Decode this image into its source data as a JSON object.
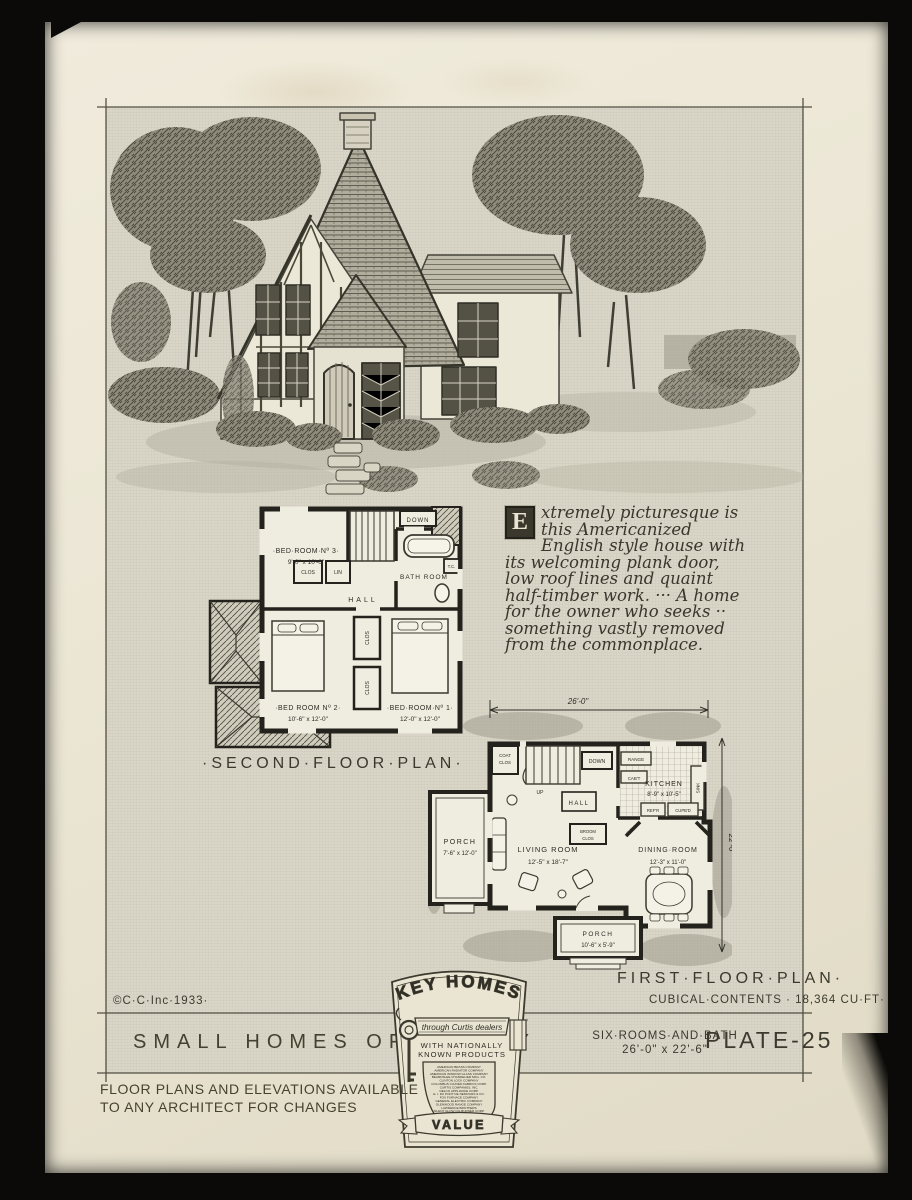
{
  "description": {
    "initial": "E",
    "lines": [
      "xtremely picturesque is",
      "this Americanized",
      "English style house with",
      "its welcoming plank door,",
      "low roof lines and quaint",
      "half-timber work. ··· A home",
      "for the owner who seeks ··",
      "something vastly removed",
      "from the commonplace."
    ]
  },
  "second_floor": {
    "title": "·SECOND·FLOOR·PLAN·",
    "bedroom3_name": "·BED·ROOM·Nº 3·",
    "bedroom3_dims": "9'-0\" x 10'-0\"",
    "bedroom2_name": "·BED ROOM Nº 2·",
    "bedroom2_dims": "10'-6\" x 12'-0\"",
    "bedroom1_name": "·BED·ROOM·Nº 1·",
    "bedroom1_dims": "12'-0\" x 12'-0\"",
    "bathroom": "BATH ROOM",
    "hall": "HALL",
    "closet_a": "CLOS",
    "linen": "LIN",
    "down": "DOWN",
    "tc": "T.C.",
    "closet_b": "CLOS",
    "closet_c": "CLOS"
  },
  "first_floor": {
    "title": "FIRST·FLOOR·PLAN·",
    "living_name": "LIVING ROOM",
    "living_dims": "12'-5\" x 18'-7\"",
    "dining_name": "DINING·ROOM",
    "dining_dims": "12'-3\" x 11'-0\"",
    "kitchen_name": "KITCHEN",
    "kitchen_dims": "8'-9\" x 10'-5\"",
    "porch_side_name": "PORCH",
    "porch_side_dims": "7'-6\" x 12'-0\"",
    "porch_front_name": "PORCH",
    "porch_front_dims": "10'-6\" x 5'-9\"",
    "hall": "HALL",
    "coat1": "COAT",
    "coat2": "CLOS",
    "up": "UP",
    "down": "DOWN",
    "range": "RANGE",
    "cabt": "CAB'T",
    "sink": "SINK",
    "refr": "REF'R",
    "cupbd": "CUPB'D",
    "broom1": "BROOM",
    "broom2": "CLOS",
    "china_left": "CHINA",
    "china_right": "CHINA",
    "dim_width": "26'-0\"",
    "dim_depth": "22'-6\""
  },
  "titleblock": {
    "copyright": "©C·C·Inc·1933·",
    "cubical": "CUBICAL·CONTENTS · 18,364 CU·FT·",
    "series": "SMALL HOMES OF TO·DAY",
    "rooms_line1": "SIX·ROOMS·AND·BATH",
    "rooms_line2": "26'-0\" x 22'-6\"",
    "plate": "PLATE-25"
  },
  "emblem": {
    "title": "KEY HOMES",
    "banner": "through Curtis dealers",
    "tagline1": "WITH NATIONALLY",
    "tagline2": "KNOWN PRODUCTS",
    "companies": [
      "AMERICAN BRASS COMPANY",
      "AMERICAN RADIATOR COMPANY",
      "AMERICAN WINDOW GLASS COMPANY",
      "BEARDSLEE CHANDELIER MFG. CO.",
      "CLINTON LOCK COMPANY",
      "COLUMBUS COATED FABRICS CORP.",
      "CURTIS COMPANIES, INC.",
      "DELCO APPLIANCE CORP.",
      "E. I. DU PONT DE NEMOURS & CO.",
      "FOX FURNACE COMPANY",
      "GENERAL ELECTRIC COMPANY",
      "GLENWOOD RANGE COMPANY",
      "LAWRENCE BROTHERS",
      "SILENT GLOW OIL BURNER CORP.",
      "STANDARD SANITARY MFG. CO."
    ],
    "value": "VALUE"
  },
  "footer": {
    "line1": "FLOOR PLANS AND ELEVATIONS AVAILABLE",
    "line2": "TO ANY ARCHITECT FOR CHANGES"
  },
  "colors": {
    "paper": "#ebe6d4",
    "plate_tint": "#d9d6c7",
    "ink": "#2e2d25",
    "background": "#0b0a08"
  }
}
